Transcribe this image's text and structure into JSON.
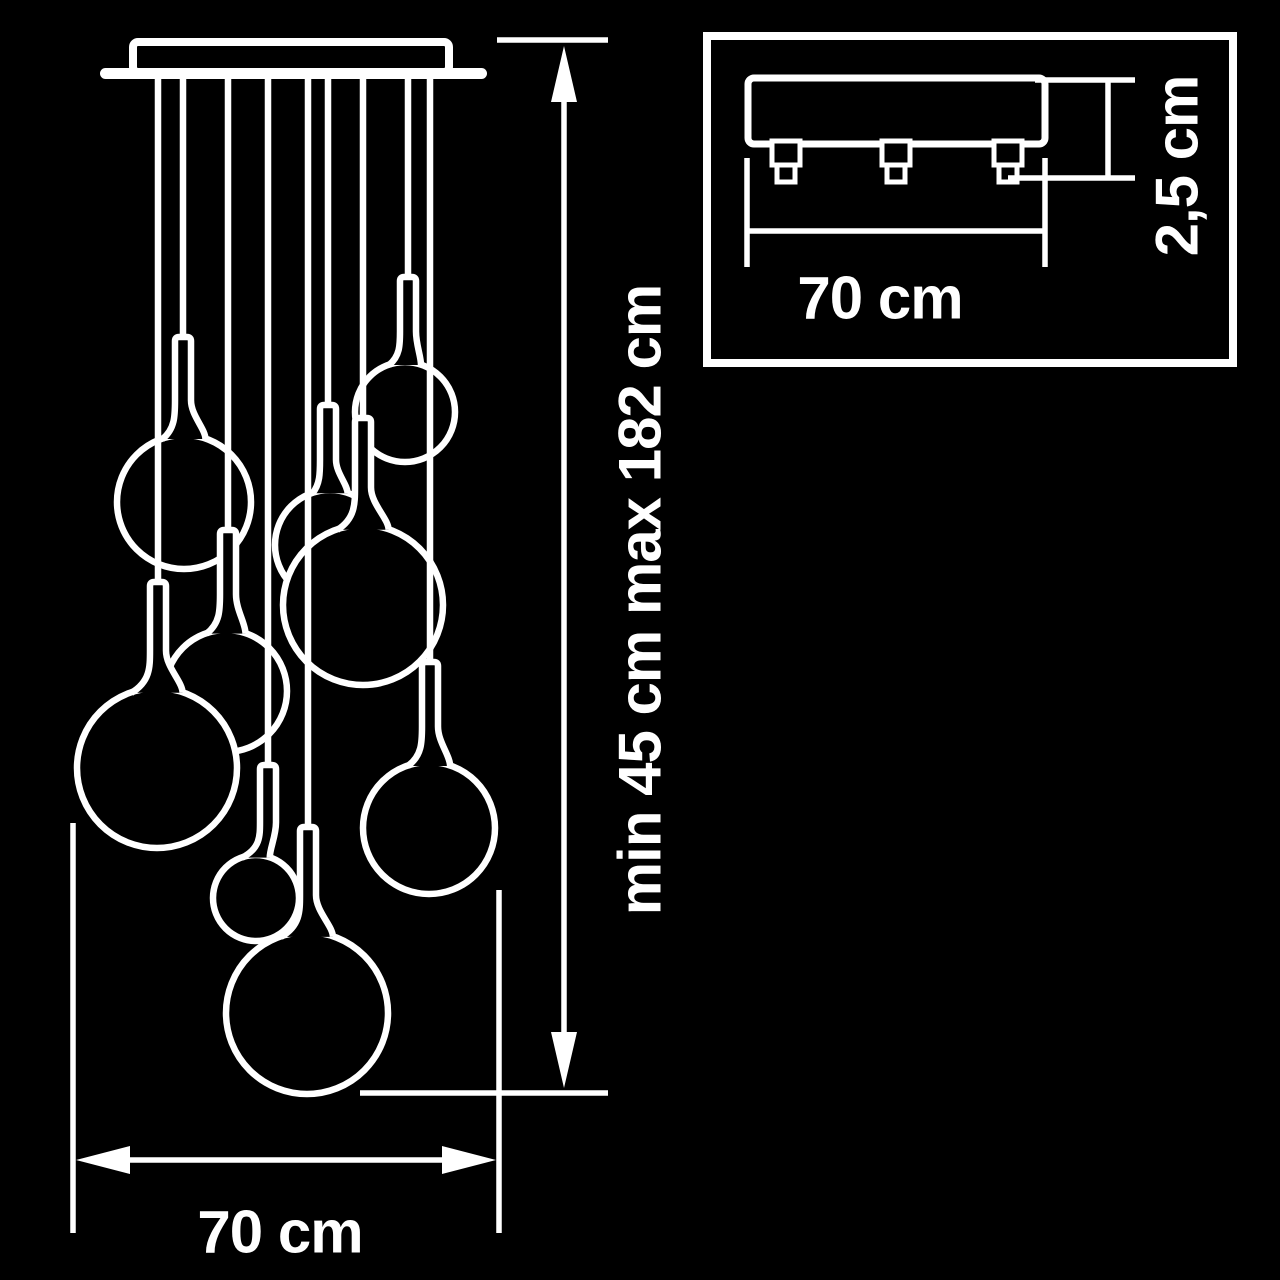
{
  "figure_type": "pendant-chandelier-technical-drawing",
  "colors": {
    "background": "#000000",
    "line": "#ffffff"
  },
  "labels": {
    "height_range": "min 45 cm max 182 cm",
    "fixture_width": "70 cm",
    "base_width": "70 cm",
    "base_thickness": "2,5 cm"
  },
  "main_view": {
    "cord_top_y": 76,
    "canopy": {
      "bar": {
        "x": 100,
        "y": 68,
        "w": 387,
        "h": 11
      },
      "box": {
        "x": 133,
        "y": 42,
        "w": 316,
        "h": 30
      }
    },
    "pendants": [
      {
        "id": "p8",
        "cord_x": 408,
        "cap_top": 277,
        "globe": {
          "cx": 405,
          "cy": 412,
          "r": 50
        }
      },
      {
        "id": "p2",
        "cord_x": 183,
        "cap_top": 337,
        "globe": {
          "cx": 184,
          "cy": 502,
          "r": 67
        }
      },
      {
        "id": "p6",
        "cord_x": 328,
        "cap_top": 405,
        "globe": {
          "cx": 330,
          "cy": 545,
          "r": 55
        }
      },
      {
        "id": "p7",
        "cord_x": 363,
        "cap_top": 418,
        "globe": {
          "cx": 363,
          "cy": 605,
          "r": 80
        }
      },
      {
        "id": "p3",
        "cord_x": 228,
        "cap_top": 530,
        "globe": {
          "cx": 226,
          "cy": 691,
          "r": 61
        }
      },
      {
        "id": "p1",
        "cord_x": 158,
        "cap_top": 582,
        "globe": {
          "cx": 157,
          "cy": 768,
          "r": 80
        }
      },
      {
        "id": "p9",
        "cord_x": 430,
        "cap_top": 662,
        "globe": {
          "cx": 429,
          "cy": 828,
          "r": 66
        }
      },
      {
        "id": "p4",
        "cord_x": 268,
        "cap_top": 765,
        "globe": {
          "cx": 256,
          "cy": 898,
          "r": 43
        }
      },
      {
        "id": "p5",
        "cord_x": 308,
        "cap_top": 827,
        "globe": {
          "cx": 307,
          "cy": 1013,
          "r": 81
        }
      }
    ],
    "dim_vertical": {
      "x": 564,
      "arrow_top_y": 46,
      "arrow_bottom_y": 1088,
      "tick_top": {
        "y": 40,
        "x1": 497,
        "x2": 608
      },
      "tick_bottom": {
        "y": 1093,
        "x1": 360,
        "x2": 608
      }
    },
    "dim_horizontal": {
      "y": 1160,
      "x1": 76,
      "x2": 496,
      "ext_left": {
        "x": 73,
        "y1": 823,
        "y2": 1233
      },
      "ext_right": {
        "x": 499,
        "y1": 890,
        "y2": 1233
      }
    }
  },
  "inset_view": {
    "border": {
      "x": 707,
      "y": 36,
      "w": 526,
      "h": 327
    },
    "plate": {
      "x": 748,
      "y": 78,
      "w": 297,
      "h": 66
    },
    "feet_cx": [
      786,
      896,
      1008
    ],
    "feet": {
      "top_w": 28,
      "top_h": 24,
      "top_y": 141,
      "bot_w": 18,
      "bot_h": 17,
      "bot_y": 165
    },
    "dim_width": {
      "x1": 747,
      "x2": 1045,
      "line_y": 231,
      "ext_y1": 158,
      "ext_y2": 267
    },
    "dim_height": {
      "x": 1108,
      "y1": 80,
      "y2": 178,
      "tick_top": {
        "x1": 1035,
        "x2": 1135,
        "y": 80
      },
      "tick_bottom": {
        "x1": 1008,
        "x2": 1135,
        "y": 178
      }
    }
  }
}
